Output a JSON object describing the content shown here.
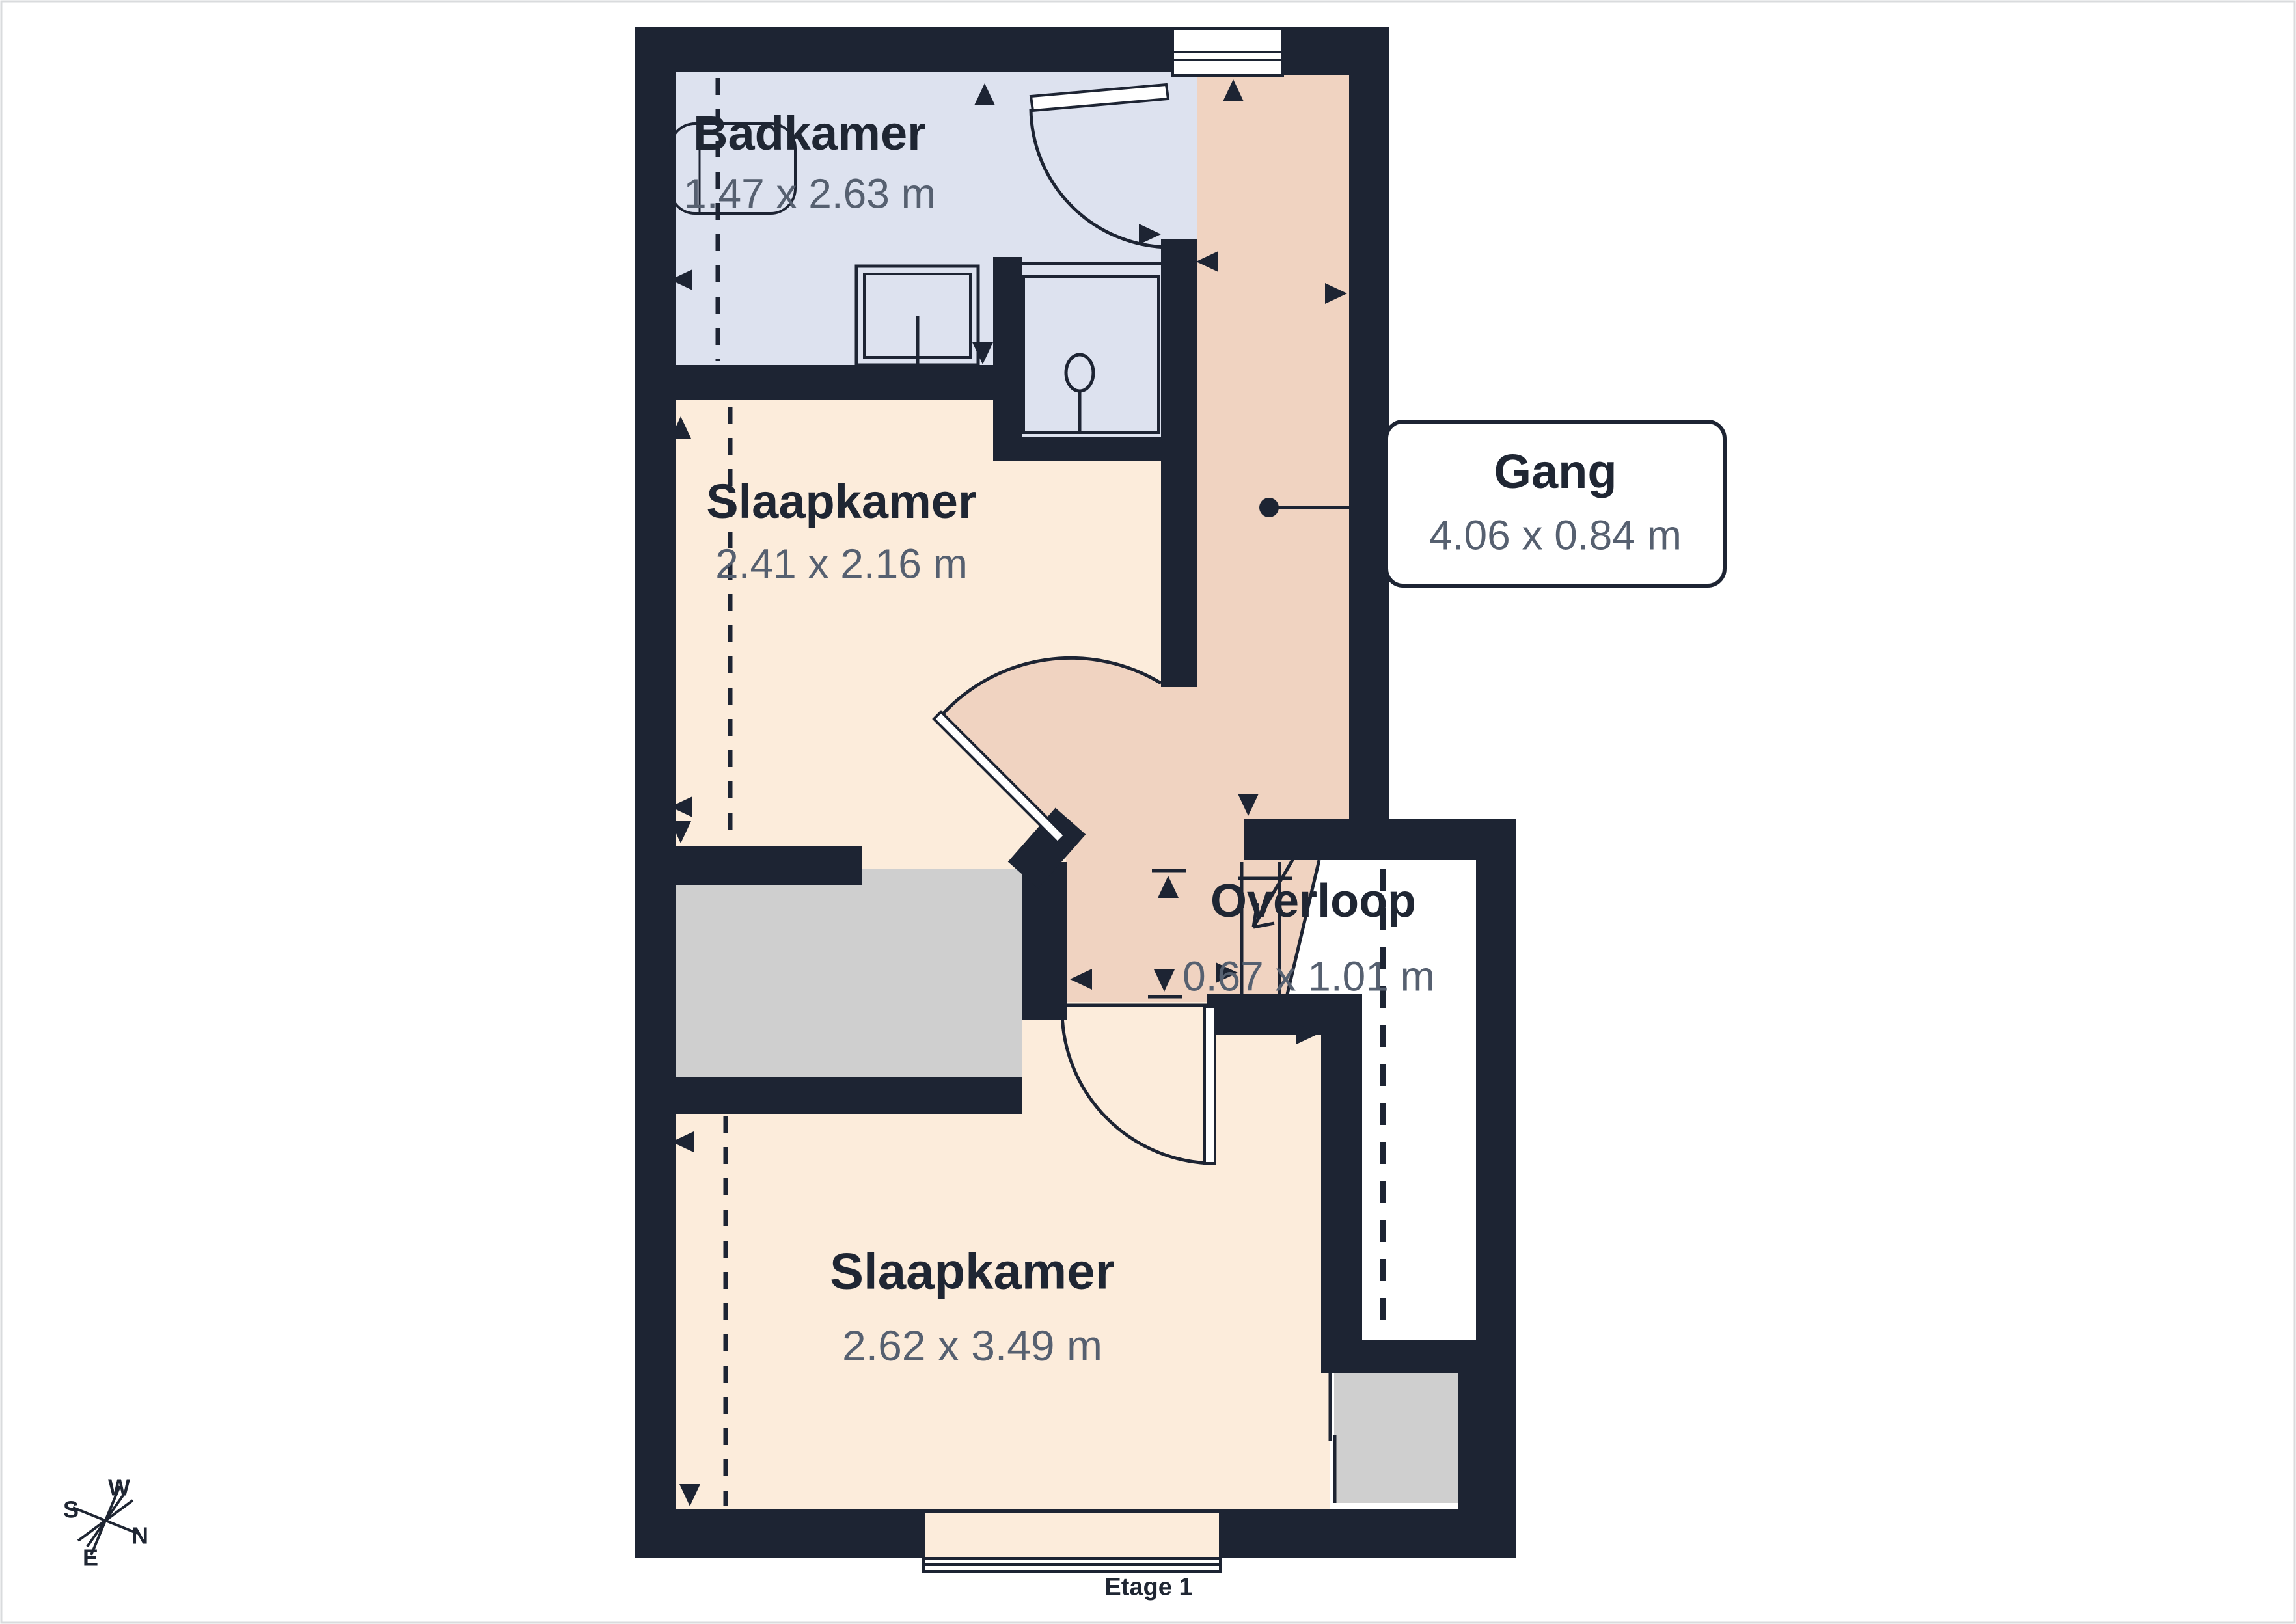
{
  "floor_label": "Etage 1",
  "rooms": [
    {
      "id": "badkamer",
      "name": "Badkamer",
      "dimensions": "1.47 x 2.63 m"
    },
    {
      "id": "slaapkamer-1",
      "name": "Slaapkamer",
      "dimensions": "2.41 x 2.16 m"
    },
    {
      "id": "gang",
      "name": "Gang",
      "dimensions": "4.06 x 0.84 m"
    },
    {
      "id": "overloop",
      "name": "Overloop",
      "dimensions": "0.67 x 1.01 m"
    },
    {
      "id": "slaapkamer-2",
      "name": "Slaapkamer",
      "dimensions": "2.62 x 3.49 m"
    }
  ],
  "compass": {
    "north": "N",
    "east": "E",
    "south": "S",
    "west": "W"
  },
  "colors": {
    "wall": "#1d2433",
    "bathroom": "#dde2ef",
    "bedroom": "#fcecdb",
    "hallway": "#f0d3c1",
    "closet": "#cfcfcf",
    "void": "#ffffff",
    "title_text": "#1f2633",
    "dims_text": "#566070",
    "page_border": "#d9dbdd"
  }
}
